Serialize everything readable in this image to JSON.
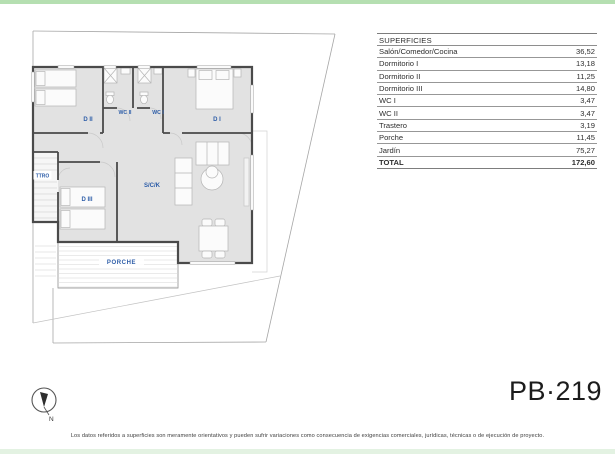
{
  "page": {
    "project_code": "PB·219",
    "disclaimer": "Los datos referidos a superficies son meramente orientativos y pueden sufrir variaciones como consecuencia de exigencias comerciales, jurídicas, técnicas o de ejecución de proyecto.",
    "compass_label": "N"
  },
  "colors": {
    "top_strip_green": "#b5dfb1",
    "bottom_strip_green": "#e3f2e2",
    "room_label_blue": "#2d5da8",
    "wall_gray": "#4a4a4a",
    "floor_gray": "#e2e2e2"
  },
  "floorplan": {
    "labels": {
      "dormitorio2": "D II",
      "wc2": "WC II",
      "wc1": "WC I",
      "dormitorio1": "D I",
      "trastero": "TTRO",
      "dormitorio3": "D III",
      "salon_comedor_cocina": "S/C/K",
      "porche": "PORCHE"
    }
  },
  "table": {
    "header": "SUPERFICIES",
    "rows": [
      {
        "label": "Salón/Comedor/Cocina",
        "value": "36,52"
      },
      {
        "label": "Dormitorio I",
        "value": "13,18"
      },
      {
        "label": "Dormitorio II",
        "value": "11,25"
      },
      {
        "label": "Dormitorio III",
        "value": "14,80"
      },
      {
        "label": "WC I",
        "value": "3,47"
      },
      {
        "label": "WC II",
        "value": "3,47"
      },
      {
        "label": "Trastero",
        "value": "3,19"
      },
      {
        "label": "Porche",
        "value": "11,45"
      },
      {
        "label": "Jardín",
        "value": "75,27"
      }
    ],
    "total": {
      "label": "TOTAL",
      "value": "172,60"
    }
  }
}
